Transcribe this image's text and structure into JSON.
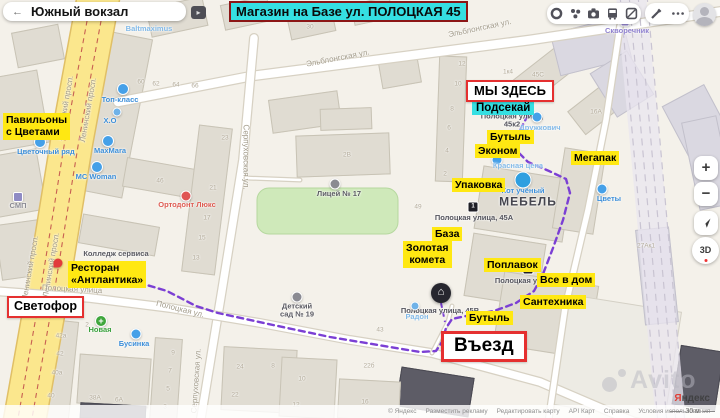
{
  "app": {
    "search": {
      "back_glyph": "←",
      "title": "Южный вокзал",
      "collapse_glyph": "▸"
    },
    "banner_title": "Магазин на Базе ул. ПОЛОЦКАЯ 45"
  },
  "controls": {
    "zoom_in": "+",
    "zoom_out": "−",
    "compass_label": "3D"
  },
  "attribution": {
    "copyright": "© Яндекс",
    "links": [
      "Разместить рекламу",
      "Редактировать карту",
      "API Карт",
      "Справка",
      "Условия использования"
    ],
    "logo_first": "Я",
    "logo_rest": "ндекс",
    "scale_label": "30 м"
  },
  "watermark": {
    "text": "Avito"
  },
  "colors": {
    "annotation_yellow": "#ffe812",
    "annotation_cyan": "#35dfe2",
    "annotation_red": "#e53030",
    "route_purple": "#7b3fd4"
  },
  "annotations": {
    "boxes": [
      {
        "t": "МЫ ЗДЕСЬ",
        "x": 466,
        "y": 80,
        "fs": 13,
        "bw": 2.5,
        "pd": "2px 6px"
      },
      {
        "t": "Светофор",
        "x": 7,
        "y": 296,
        "fs": 12.5,
        "bw": 2,
        "pd": "2px 5px"
      },
      {
        "t": "Въезд",
        "x": 441,
        "y": 331,
        "fs": 19,
        "bw": 3,
        "pd": "2px 10px"
      }
    ],
    "cyan": [
      {
        "t": "Подсекай",
        "x": 472,
        "y": 101
      }
    ],
    "yellow": [
      {
        "t": "Павильоны\nс Цветами",
        "x": 3,
        "y": 113,
        "al": true
      },
      {
        "t": "Бутыль",
        "x": 487,
        "y": 130
      },
      {
        "t": "Эконом",
        "x": 475,
        "y": 144
      },
      {
        "t": "Мегапак",
        "x": 571,
        "y": 151
      },
      {
        "t": "Упаковка",
        "x": 452,
        "y": 178
      },
      {
        "t": "База",
        "x": 432,
        "y": 227
      },
      {
        "t": "Золотая\nкомета",
        "x": 403,
        "y": 241
      },
      {
        "t": "Ресторан\n«Антлантика»",
        "x": 68,
        "y": 261,
        "al": true
      },
      {
        "t": "Поплавок",
        "x": 484,
        "y": 258
      },
      {
        "t": "Все в дом",
        "x": 537,
        "y": 273
      },
      {
        "t": "Сантехника",
        "x": 520,
        "y": 295
      },
      {
        "t": "Бутыль",
        "x": 466,
        "y": 311
      }
    ],
    "marker": {
      "x": 441,
      "y": 293
    },
    "red_pin": {
      "x": 58,
      "y": 263
    }
  },
  "map": {
    "area_label": {
      "t": "МЕБЕЛЬ",
      "x": 528,
      "y": 202
    },
    "street_labels": [
      {
        "t": "Эльблонгская ул.",
        "x": 338,
        "y": 59,
        "r": -11
      },
      {
        "t": "Эльблонгская ул.",
        "x": 480,
        "y": 29,
        "r": -12
      },
      {
        "t": "Ленинский просп.",
        "x": 66,
        "y": 108,
        "r": -80
      },
      {
        "t": "Ленинский просп.",
        "x": 89,
        "y": 110,
        "r": -80
      },
      {
        "t": "Ленинский просп.",
        "x": 31,
        "y": 268,
        "r": -80
      },
      {
        "t": "Ленинский просп.",
        "x": 52,
        "y": 265,
        "r": -80
      },
      {
        "t": "Серпуховская ул.",
        "x": 245,
        "y": 157,
        "r": 90
      },
      {
        "t": "Серпуховская ул.",
        "x": 197,
        "y": 381,
        "r": -86
      },
      {
        "t": "Полоцкая улица",
        "x": 72,
        "y": 290,
        "r": 3
      },
      {
        "t": "Полоцкая ул.",
        "x": 180,
        "y": 310,
        "r": 14
      }
    ],
    "poi_labels": [
      {
        "t": "Baltmaximus",
        "x": 149,
        "y": 29,
        "c": "lightblue"
      },
      {
        "t": "Топ-класс",
        "x": 120,
        "y": 100,
        "c": "blue",
        "icon": "shirt",
        "ix": 123,
        "iy": 89
      },
      {
        "t": "Х.О",
        "x": 110,
        "y": 121,
        "c": "blue",
        "icon": "dot",
        "ix": 117,
        "iy": 112
      },
      {
        "t": "MaxMara",
        "x": 110,
        "y": 151,
        "c": "blue",
        "icon": "shirt",
        "ix": 108,
        "iy": 141
      },
      {
        "t": "MC Woman",
        "x": 96,
        "y": 177,
        "c": "blue",
        "icon": "shirt",
        "ix": 97,
        "iy": 167
      },
      {
        "t": "Цветочный ряд",
        "x": 46,
        "y": 152,
        "c": "blue",
        "icon": "shirt",
        "ix": 40,
        "iy": 142
      },
      {
        "t": "СМП",
        "x": 18,
        "y": 206,
        "c": "grey",
        "icon": "square",
        "ix": 18,
        "iy": 197
      },
      {
        "t": "Ортодонт Люкс",
        "x": 187,
        "y": 205,
        "c": "red",
        "icon": "reddot",
        "ix": 186,
        "iy": 196
      },
      {
        "t": "Лицей № 17",
        "x": 339,
        "y": 194,
        "c": "dark",
        "icon": "school",
        "ix": 335,
        "iy": 184
      },
      {
        "t": "Колледж сервиса",
        "x": 116,
        "y": 254,
        "c": "dark"
      },
      {
        "t": "Детский\nсад № 19",
        "x": 297,
        "y": 311,
        "c": "dark",
        "icon": "school",
        "ix": 297,
        "iy": 297
      },
      {
        "t": "Новая",
        "x": 100,
        "y": 330,
        "c": "green",
        "icon": "plus",
        "ix": 101,
        "iy": 321
      },
      {
        "t": "Бусинка",
        "x": 134,
        "y": 344,
        "c": "blue",
        "icon": "bdot",
        "ix": 136,
        "iy": 334
      },
      {
        "t": "Радон",
        "x": 417,
        "y": 317,
        "c": "lightblue",
        "icon": "dot",
        "ix": 415,
        "iy": 306
      },
      {
        "t": "Красная цена",
        "x": 518,
        "y": 166,
        "c": "lightblue",
        "icon": "bdot",
        "ix": 497,
        "iy": 160
      },
      {
        "t": "Кот учёный",
        "x": 523,
        "y": 191,
        "c": "blue",
        "icon": "bigdot",
        "ix": 523,
        "iy": 180
      },
      {
        "t": "Цветы",
        "x": 609,
        "y": 199,
        "c": "blue",
        "icon": "bdot",
        "ix": 602,
        "iy": 189
      },
      {
        "t": "Дружкович",
        "x": 540,
        "y": 128,
        "c": "lightblue"
      },
      {
        "t": "",
        "x": 0,
        "y": 0,
        "c": "blue",
        "icon": "bdot",
        "ix": 537,
        "iy": 117
      },
      {
        "t": "Скворечник",
        "x": 627,
        "y": 31,
        "c": "purple",
        "icon": "pdot",
        "ix": 625,
        "iy": 22
      }
    ],
    "address_labels": [
      {
        "t": "Полоцкая улица,\n45к2",
        "x": 512,
        "y": 121
      },
      {
        "t": "Полоцкая улица, 45А",
        "x": 474,
        "y": 218
      },
      {
        "t": "Полоцкая улица, 45В",
        "x": 440,
        "y": 311
      },
      {
        "t": "Полоцкая у",
        "x": 516,
        "y": 281
      }
    ],
    "building_numbers": [
      [
        "30",
        310,
        27
      ],
      [
        "60",
        141,
        82
      ],
      [
        "62",
        156,
        84
      ],
      [
        "64",
        176,
        85
      ],
      [
        "66",
        195,
        86
      ],
      [
        "12",
        462,
        64
      ],
      [
        "10",
        458,
        84
      ],
      [
        "8",
        452,
        109
      ],
      [
        "6",
        449,
        128
      ],
      [
        "4",
        447,
        151
      ],
      [
        "2",
        445,
        174
      ],
      [
        "1к4",
        508,
        72
      ],
      [
        "45С",
        538,
        75
      ],
      [
        "16А",
        596,
        112
      ],
      [
        "23",
        225,
        138
      ],
      [
        "21",
        213,
        188
      ],
      [
        "17",
        207,
        218
      ],
      [
        "15",
        202,
        238
      ],
      [
        "13",
        196,
        258
      ],
      [
        "46",
        160,
        181
      ],
      [
        "2В",
        347,
        155
      ],
      [
        "49",
        418,
        207
      ],
      [
        "27Ак1",
        646,
        246
      ],
      [
        "43",
        380,
        330
      ],
      [
        "24",
        240,
        367
      ],
      [
        "22",
        235,
        395
      ],
      [
        "8",
        273,
        366
      ],
      [
        "10",
        302,
        379
      ],
      [
        "12",
        296,
        405
      ],
      [
        "16",
        365,
        402
      ],
      [
        "22б",
        369,
        366
      ],
      [
        "42а",
        61,
        336
      ],
      [
        "42",
        60,
        354
      ],
      [
        "40а",
        57,
        373
      ],
      [
        "40",
        51,
        396
      ],
      [
        "9",
        173,
        353
      ],
      [
        "7",
        170,
        371
      ],
      [
        "5",
        168,
        389
      ],
      [
        "3",
        165,
        407
      ],
      [
        "38А",
        95,
        398
      ],
      [
        "6А",
        119,
        400
      ],
      [
        "2",
        87,
        325
      ]
    ],
    "bus_stops": [
      {
        "n": "1",
        "x": 473,
        "y": 207
      },
      {
        "n": "3",
        "x": 528,
        "y": 269
      }
    ],
    "buildings": [
      [
        -14,
        74,
        58,
        74,
        -10,
        "g"
      ],
      [
        -8,
        152,
        50,
        62,
        -10,
        "g"
      ],
      [
        -2,
        222,
        44,
        56,
        -8,
        "g"
      ],
      [
        14,
        28,
        48,
        36,
        -11,
        "g"
      ],
      [
        96,
        34,
        42,
        162,
        11,
        "g"
      ],
      [
        148,
        2,
        58,
        30,
        -12,
        "g"
      ],
      [
        222,
        0,
        48,
        26,
        -12,
        "g"
      ],
      [
        288,
        8,
        46,
        28,
        -12,
        "g"
      ],
      [
        352,
        0,
        40,
        22,
        -12,
        "g"
      ],
      [
        124,
        163,
        72,
        30,
        10,
        "g"
      ],
      [
        190,
        126,
        34,
        148,
        7,
        "g"
      ],
      [
        80,
        220,
        78,
        30,
        10,
        "g"
      ],
      [
        270,
        95,
        70,
        34,
        -8,
        "g"
      ],
      [
        380,
        60,
        40,
        26,
        -10,
        "g"
      ],
      [
        296,
        134,
        94,
        42,
        -2,
        "g"
      ],
      [
        320,
        108,
        52,
        22,
        -2,
        "g"
      ],
      [
        437,
        56,
        28,
        126,
        2,
        "g"
      ],
      [
        512,
        58,
        68,
        30,
        -38,
        "g"
      ],
      [
        570,
        90,
        60,
        30,
        -38,
        "g"
      ],
      [
        554,
        24,
        74,
        44,
        -14,
        "l"
      ],
      [
        600,
        58,
        44,
        52,
        -32,
        "l"
      ],
      [
        672,
        92,
        48,
        56,
        -28,
        "l"
      ],
      [
        690,
        118,
        36,
        90,
        -12,
        "l"
      ],
      [
        478,
        172,
        90,
        64,
        9,
        "g"
      ],
      [
        558,
        150,
        42,
        82,
        9,
        "g"
      ],
      [
        468,
        238,
        74,
        64,
        9,
        "g"
      ],
      [
        498,
        278,
        96,
        74,
        9,
        "g"
      ],
      [
        556,
        302,
        118,
        112,
        9,
        "w"
      ],
      [
        676,
        348,
        44,
        60,
        9,
        "k"
      ],
      [
        398,
        372,
        74,
        40,
        9,
        "k"
      ],
      [
        640,
        228,
        34,
        96,
        -6,
        "l"
      ],
      [
        42,
        320,
        32,
        100,
        6,
        "g"
      ],
      [
        78,
        356,
        72,
        50,
        4,
        "g"
      ],
      [
        152,
        338,
        28,
        84,
        4,
        "g"
      ],
      [
        222,
        348,
        74,
        64,
        3,
        "g"
      ],
      [
        280,
        358,
        56,
        60,
        3,
        "g"
      ],
      [
        338,
        380,
        62,
        40,
        3,
        "g"
      ],
      [
        80,
        404,
        66,
        16,
        3,
        "k"
      ]
    ],
    "green_field": {
      "x": 257,
      "y": 188,
      "w": 141,
      "h": 46
    },
    "rail_zone": [
      [
        616,
        -5
      ],
      [
        646,
        -5
      ],
      [
        686,
        423
      ],
      [
        656,
        423
      ]
    ],
    "rails": [
      [
        620,
        -5,
        658,
        423
      ],
      [
        629,
        -5,
        667,
        423
      ],
      [
        638,
        -5,
        676,
        423
      ],
      [
        647,
        -5,
        685,
        423
      ]
    ],
    "roads": [
      {
        "kind": "yellow",
        "w": 44,
        "pts": [
          [
            99,
            -6
          ],
          [
            72,
            140
          ],
          [
            46,
            300
          ],
          [
            24,
            424
          ]
        ]
      },
      {
        "kind": "white",
        "w": 11,
        "pts": [
          [
            118,
            102
          ],
          [
            252,
            76
          ],
          [
            530,
            40
          ],
          [
            724,
            11
          ]
        ]
      },
      {
        "kind": "white",
        "w": 10,
        "pts": [
          [
            254,
            38
          ],
          [
            243,
            160
          ],
          [
            222,
            290
          ],
          [
            200,
            424
          ]
        ]
      },
      {
        "kind": "white",
        "w": 10,
        "pts": [
          [
            -6,
            291
          ],
          [
            90,
            298
          ],
          [
            170,
            308
          ],
          [
            260,
            323
          ],
          [
            350,
            340
          ],
          [
            432,
            353
          ],
          [
            540,
            382
          ],
          [
            610,
            412
          ],
          [
            640,
            424
          ]
        ]
      },
      {
        "kind": "white",
        "w": 8,
        "pts": [
          [
            620,
            26
          ],
          [
            606,
            120
          ],
          [
            588,
            210
          ],
          [
            565,
            308
          ],
          [
            548,
            424
          ]
        ]
      },
      {
        "kind": "white",
        "w": 5,
        "pts": [
          [
            246,
            178
          ],
          [
            300,
            180
          ]
        ]
      },
      {
        "kind": "white",
        "w": 5,
        "pts": [
          [
            432,
            353
          ],
          [
            448,
            322
          ],
          [
            452,
            306
          ]
        ]
      }
    ],
    "route": [
      [
        528,
        115
      ],
      [
        519,
        132
      ],
      [
        516,
        150
      ],
      [
        528,
        162
      ],
      [
        549,
        171
      ],
      [
        566,
        179
      ],
      [
        570,
        193
      ],
      [
        563,
        220
      ],
      [
        553,
        248
      ],
      [
        543,
        274
      ],
      [
        534,
        291
      ],
      [
        516,
        303
      ],
      [
        494,
        311
      ],
      [
        471,
        315
      ],
      [
        452,
        319
      ],
      [
        446,
        328
      ],
      [
        442,
        342
      ],
      [
        436,
        351
      ],
      [
        420,
        352
      ],
      [
        378,
        345
      ],
      [
        330,
        337
      ],
      [
        273,
        325
      ],
      [
        218,
        313
      ],
      [
        196,
        306
      ],
      [
        167,
        291
      ],
      [
        140,
        283
      ],
      [
        117,
        277
      ]
    ],
    "route_spur": [
      [
        441,
        303
      ],
      [
        445,
        322
      ]
    ]
  }
}
